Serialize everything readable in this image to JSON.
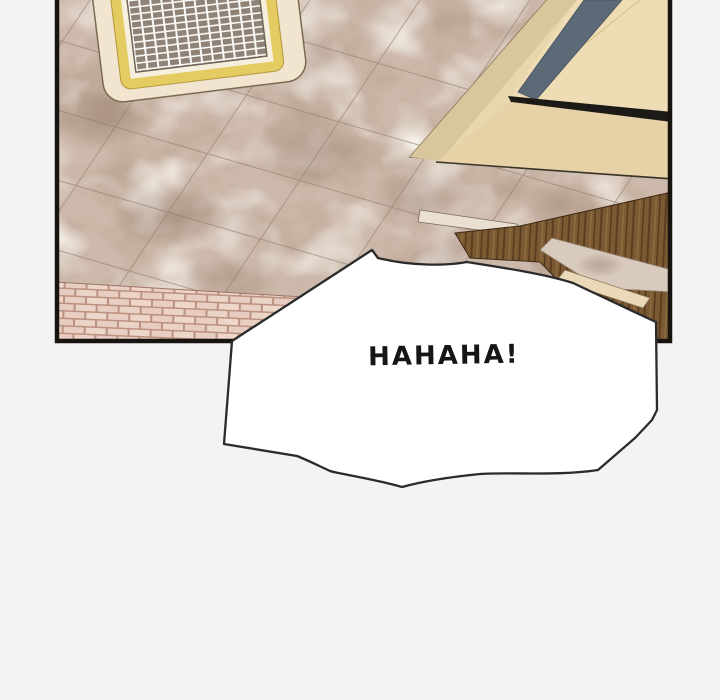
{
  "page": {
    "type": "comic-panel",
    "background": "#f3f3f5",
    "panel_border_color": "#17130f"
  },
  "bubble": {
    "text": "HAHAHA!",
    "fill": "#ffffff",
    "stroke": "#2b2b2b"
  },
  "ceiling": {
    "base": "#cdb9ab",
    "seam": "#8f7c6c"
  },
  "vent": {
    "outer": "#f1e5d0",
    "frame": "#e4cb62",
    "grille_dark": "#8e8376",
    "grille_light": "#fbfaf6"
  },
  "lightbox": {
    "outer": "#e8d6ae",
    "side": "#d9c69c",
    "inner": "#eddcb4",
    "bottom": "#e6d2a6",
    "stripe": "#5c6a78",
    "slot": "#1c1a17"
  },
  "wood": {
    "base": "#7b5a33",
    "grain_dark": "#5a3e1f",
    "grain_light": "#8f6c40"
  },
  "beam": {
    "cream": "#ead9b8",
    "fascia": "#e9e0d2",
    "plaster": "#d8cabc"
  },
  "brick": {
    "mortar": "#bb9180",
    "face": "#ecd3c8"
  }
}
